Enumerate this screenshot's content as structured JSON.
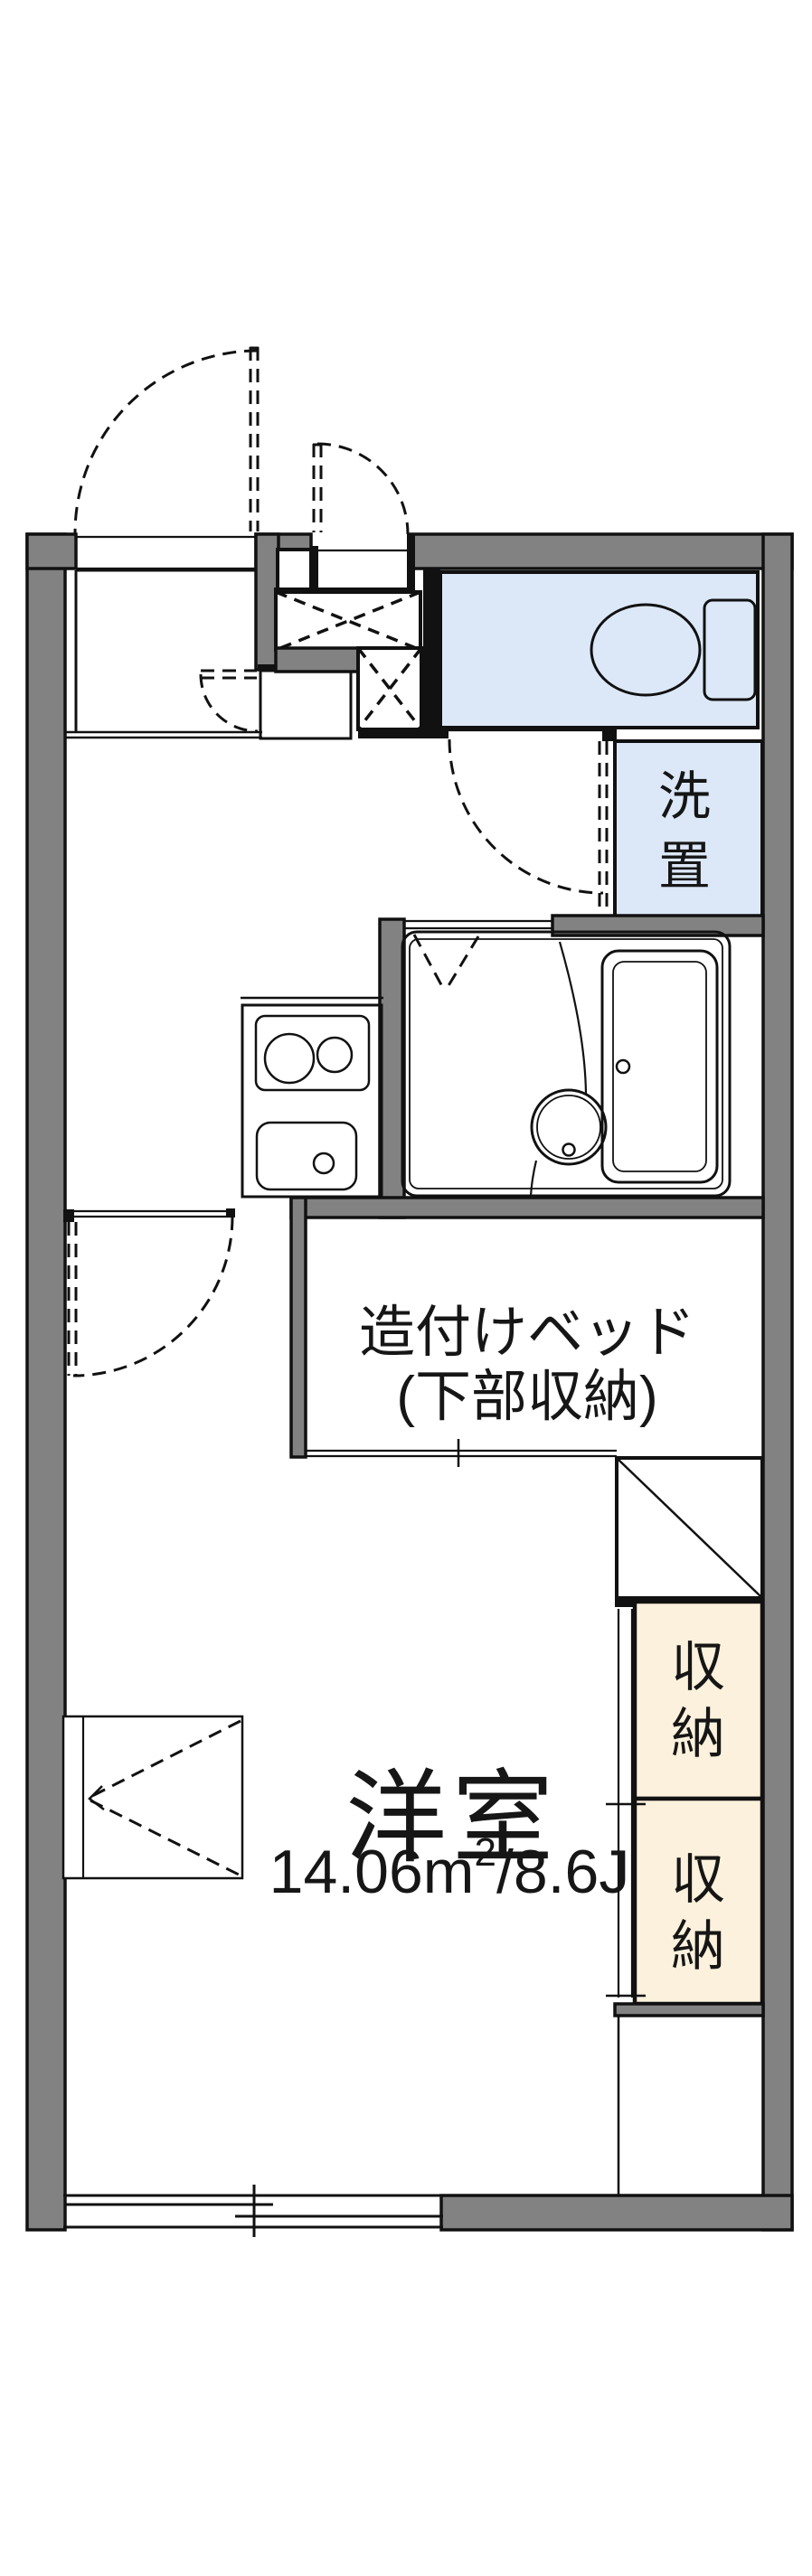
{
  "colors": {
    "wall": "#828282",
    "water": "#dce8f8",
    "storage": "#fbf1dc"
  },
  "labels": {
    "laundry": {
      "line1": "洗",
      "line2": "置"
    },
    "bed": {
      "line1": "造付けベッド",
      "line2": "(下部収納)"
    },
    "closet1": {
      "line1": "収",
      "line2": "納"
    },
    "closet2": {
      "line1": "収",
      "line2": "納"
    },
    "main_room": {
      "name": "洋室",
      "area_prefix": "14.06m",
      "area_sup": "2",
      "area_suffix": "/8.6J"
    }
  }
}
